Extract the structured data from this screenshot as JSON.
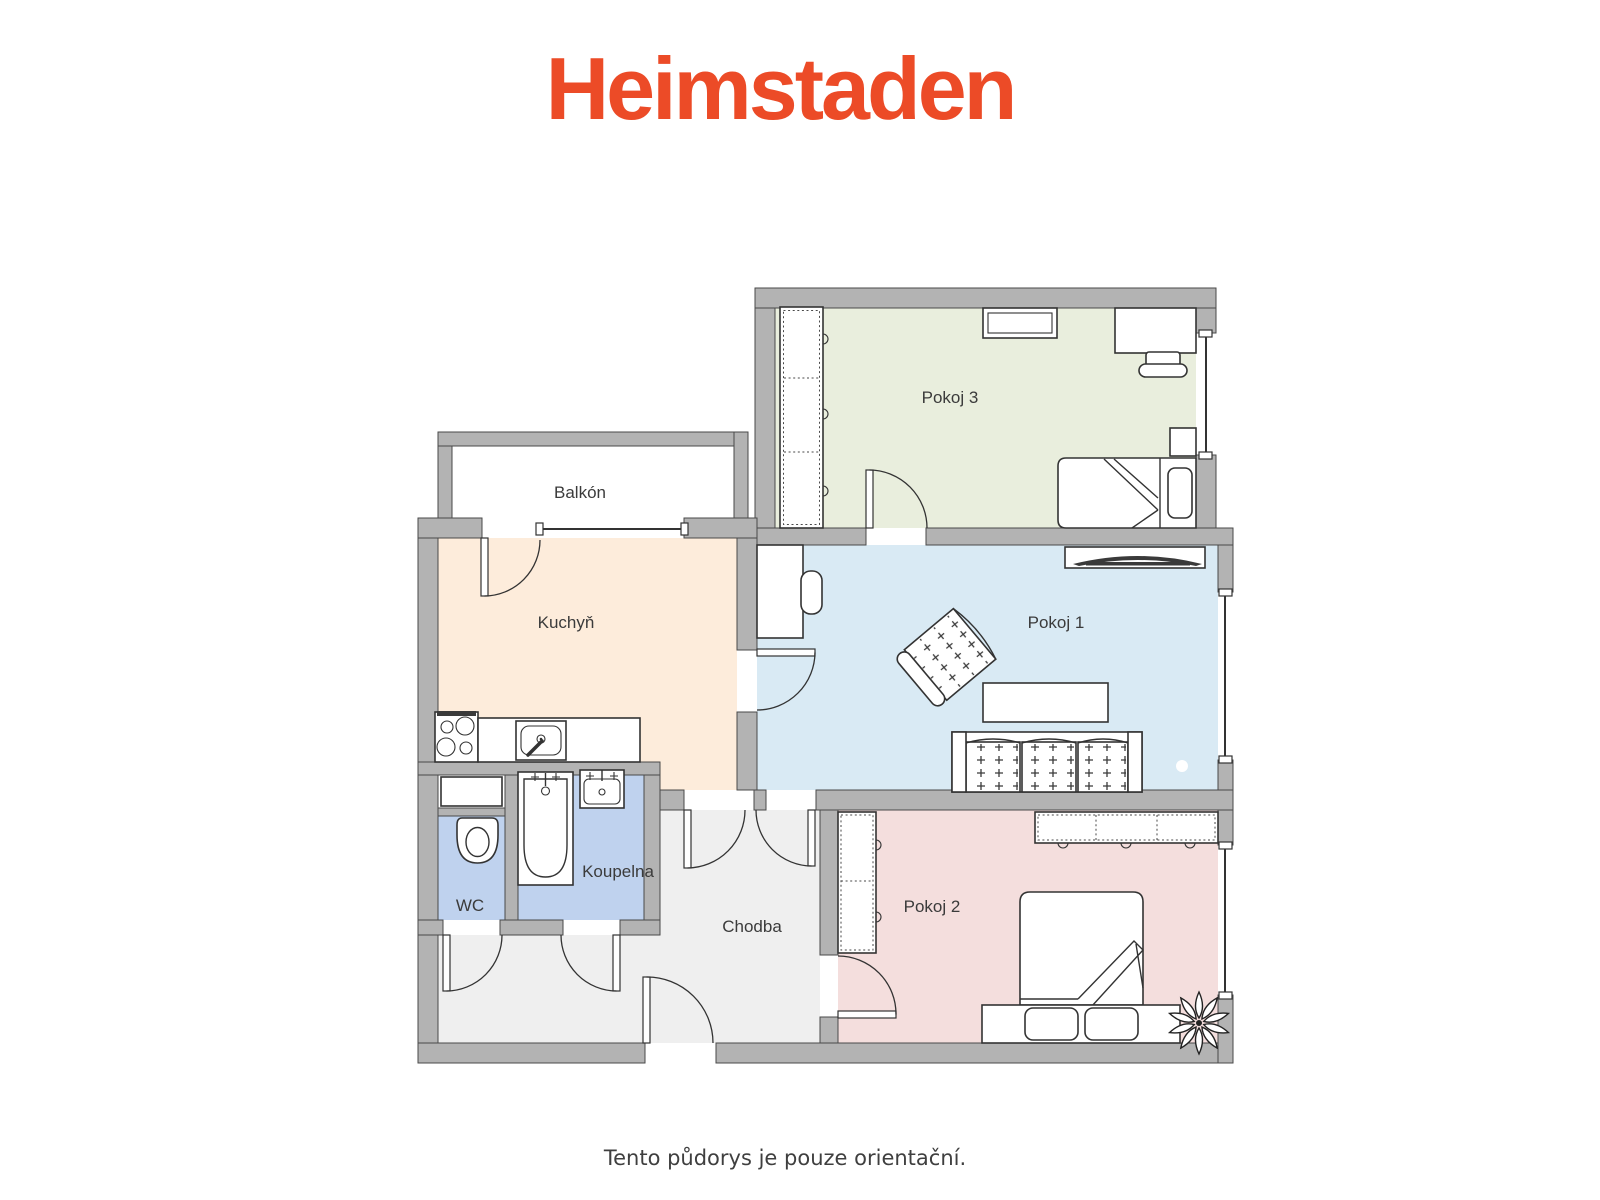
{
  "brand": {
    "name": "Heimstaden",
    "color": "#ec4b27"
  },
  "plan": {
    "wall_color": "#b3b3b3",
    "rooms": {
      "pokoj3": {
        "label": "Pokoj 3",
        "fill": "#e9eedd"
      },
      "pokoj1": {
        "label": "Pokoj 1",
        "fill": "#d9eaf4"
      },
      "pokoj2": {
        "label": "Pokoj 2",
        "fill": "#f4dedd"
      },
      "kuchyn": {
        "label": "Kuchyň",
        "fill": "#fdecdb"
      },
      "koupelna": {
        "label": "Koupelna",
        "fill": "#bfd2ee"
      },
      "wc": {
        "label": "WC",
        "fill": "#bfd2ee"
      },
      "chodba": {
        "label": "Chodba",
        "fill": "#efefef"
      },
      "balkon": {
        "label": "Balkón",
        "fill": "#ffffff"
      }
    },
    "furniture": {
      "pokoj3": [
        "wardrobe",
        "wall-shelf",
        "desk",
        "chair",
        "single-bed",
        "nightstand"
      ],
      "pokoj1": [
        "cabinet",
        "chair",
        "tv-sideboard",
        "armchair",
        "coffee-table",
        "sofa",
        "plant"
      ],
      "pokoj2": [
        "wardrobe",
        "wall-shelf",
        "double-bed",
        "bench",
        "plant"
      ],
      "kuchyn": [
        "stove",
        "countertop",
        "sink"
      ],
      "koupelna": [
        "bathtub",
        "washbasin"
      ],
      "wc": [
        "toilet",
        "cabinet"
      ]
    }
  },
  "footer": {
    "note": "Tento půdorys je pouze orientační."
  }
}
